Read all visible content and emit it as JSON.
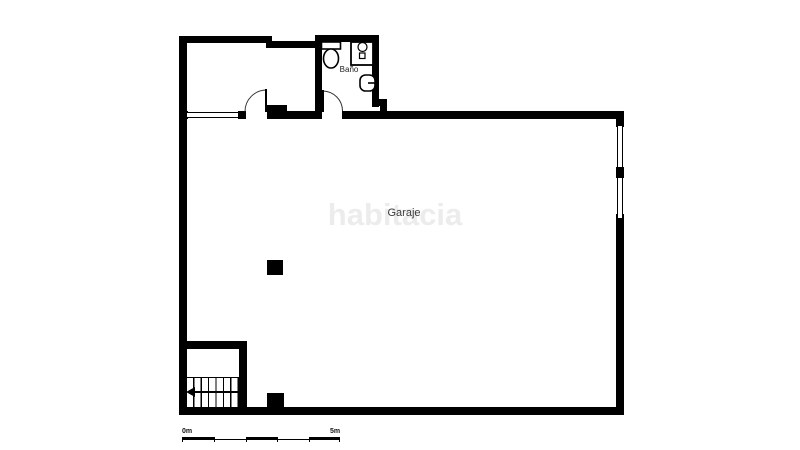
{
  "plan": {
    "rooms": {
      "garage": {
        "label": "Garaje"
      },
      "bathroom": {
        "label": "Baño"
      }
    },
    "watermark": {
      "text": "habitacia",
      "color": "#ececec"
    },
    "colors": {
      "wall": "#000000",
      "background": "#ffffff"
    },
    "fixtures": [
      "toilet-icon",
      "sink-icon",
      "bidet-icon",
      "stairs",
      "column"
    ]
  },
  "scale_bar": {
    "start_label": "0m",
    "end_label": "5m"
  }
}
